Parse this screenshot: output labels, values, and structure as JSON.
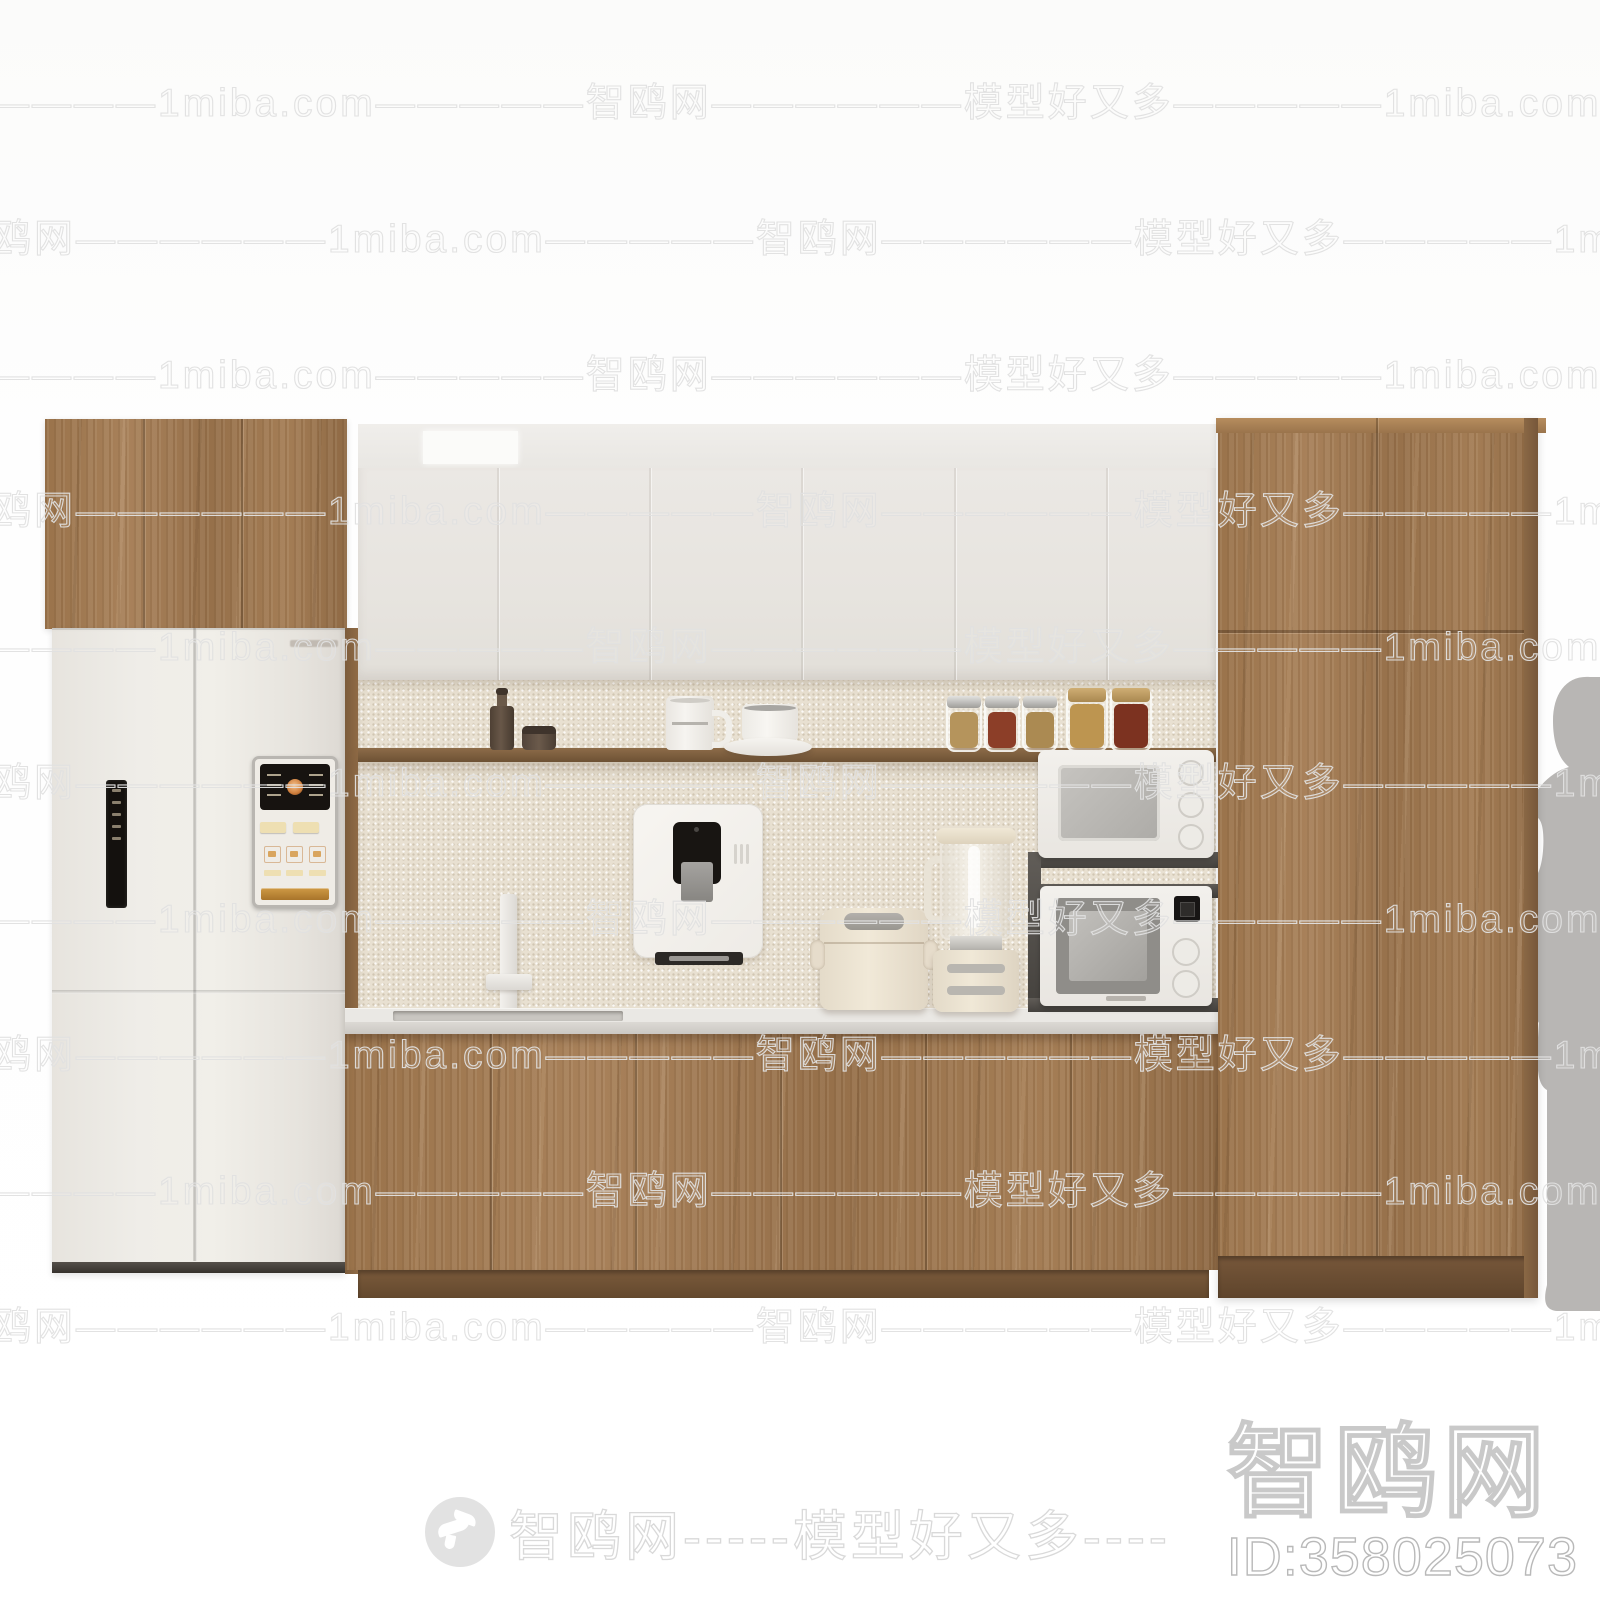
{
  "scene": {
    "type": "3d-furniture-render",
    "subject": "Modern wood kitchen cabinet wall unit",
    "objects": [
      "left wood wall cabinet over white four-door refrigerator",
      "refrigerator left-door mini display and right-door control panel with dispenser keypad",
      "white upper wall cabinets with recessed light panel",
      "open wood shelf with coffee grinder, small jar, white mug, cup and saucer, five glass spice jars",
      "wall-mounted white water dispenser with drip tray",
      "white bar faucet over slim undermount sink",
      "white stone countertop",
      "cream rice cooker",
      "glass blender on cream base",
      "two white microwave ovens stacked on dark metal rack",
      "wood base cabinets with toe kick",
      "tall right wood cabinet with split doors",
      "gray human silhouette for scale"
    ]
  },
  "watermarks": {
    "row_text": "—————智鸥网——————1miba.com—————智鸥网——————模型好又多—————1miba.com—————智鸥网——————1miba.com",
    "site_name": "智鸥网",
    "site_domain": "1miba.com",
    "tagline": "模型好又多",
    "bottom_banner": "智鸥网-----模型好又多----",
    "model_id": "ID:358025073",
    "logo_icon": "bird-logo"
  },
  "colors": {
    "wood": "#9c7850",
    "wood_dark": "#6d5134",
    "cabinet_white": "#e8e5e0",
    "backsplash": "#e8e0d1",
    "counter": "#eae8e4",
    "fridge": "#edeae5",
    "rack_metal": "#55524e",
    "silhouette": "#b8b6b4",
    "watermark": "#dedede",
    "background": "#fdfdfd"
  }
}
